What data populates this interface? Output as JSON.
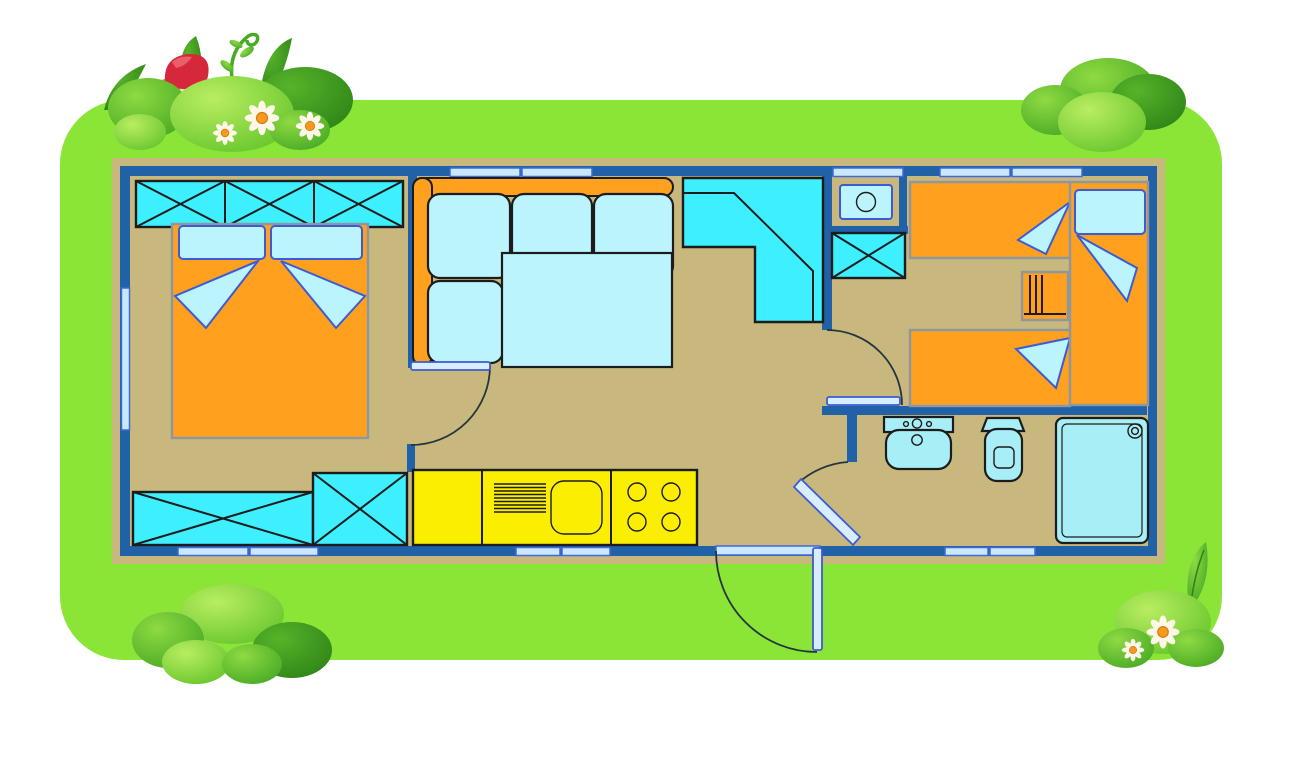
{
  "scene": {
    "name": "mobile-home-floor-plan",
    "style": "cartoon campsite illustration, top-down plan",
    "rooms": [
      {
        "name": "master-bedroom",
        "furniture": [
          "triple-wardrobe",
          "double-bed",
          "two-pillows",
          "two-blanket-folds",
          "storage-bench",
          "storage-cabinet"
        ]
      },
      {
        "name": "living-dining",
        "furniture": [
          "corner-sofa",
          "four-cushions",
          "dining-table",
          "corner-cabinet"
        ]
      },
      {
        "name": "kitchen",
        "furniture": [
          "worktop",
          "sink-with-drainer",
          "four-burner-hob"
        ]
      },
      {
        "name": "hallway",
        "furniture": [
          "entrance-door"
        ]
      },
      {
        "name": "kids-bedroom",
        "furniture": [
          "single-bed-top",
          "single-bed-bottom",
          "single-bed-right",
          "ladder-shelf",
          "storage-cabinet",
          "water-heater-niche"
        ]
      },
      {
        "name": "bathroom",
        "furniture": [
          "washbasin",
          "toilet",
          "shower"
        ]
      }
    ],
    "doors": [
      "entrance-door",
      "master-bedroom-door",
      "kids-bedroom-door",
      "bathroom-door"
    ],
    "window_count": 12,
    "decorations": [
      "bush-top-left-with-mushrooms-and-flowers",
      "bush-top-right",
      "bush-bottom-left",
      "bush-bottom-right-with-flowers-and-leaf"
    ]
  },
  "colors": {
    "grass": "#8AE537",
    "frame_tan": "#C8B87D",
    "floor_tan": "#C8B87D",
    "wall_blue": "#2061A8",
    "window_fill": "#C9E8FB",
    "window_border": "#4169D8",
    "furniture_cyan": "#3DEFFF",
    "furniture_pale": "#BCF4FE",
    "fixture_pale": "#A8EEF6",
    "bed_orange": "#FFA01E",
    "bed_outline": "#8D97A0",
    "kitchen_yellow": "#FBEE00",
    "outline_dark": "#1C1C1C",
    "pillow_outline": "#3D5BD6",
    "door_leaf": "#D8EDFE",
    "arc_line": "#233640",
    "bush_light_hi": "#B9ED62",
    "bush_light_lo": "#67C62D",
    "bush_mid_hi": "#8EDA43",
    "bush_mid_lo": "#49AA24",
    "bush_dark_hi": "#57B32A",
    "bush_dark_lo": "#2F8518",
    "mushroom_red": "#D5293B",
    "mushroom_red_hi": "#EA5E6A",
    "mushroom_orange": "#F07818",
    "mushroom_stem": "#EFE2B0",
    "flower_petal": "#FFF8E9",
    "flower_center": "#F59A1C",
    "flower_center_edge": "#D87710"
  }
}
